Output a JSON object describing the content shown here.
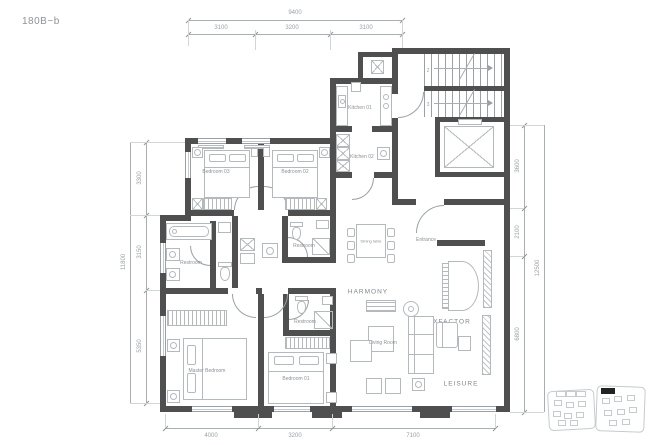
{
  "title": "180B~b",
  "rooms": {
    "bedroom03": "Bedroom 03",
    "bedroom02": "Bedroom 02",
    "kitchen01": "Kitchen 01",
    "kitchen02": "Kitchen 02",
    "restroom_main": "Restroom",
    "restroom_guest": "Restroom",
    "restroom_lower": "Restroom",
    "master_bedroom": "Master Bedroom",
    "bedroom01": "Bedroom 01",
    "living_room": "Living Room",
    "dining_table": "Dining table",
    "entrance": "Entrance"
  },
  "zones": {
    "harmony": "HARMONY",
    "xfactor": "XFACTOR",
    "leisure": "LEISURE"
  },
  "stairs": {
    "mark_upper": "2",
    "mark_lower": "3"
  },
  "dimensions": {
    "top": {
      "total": "9400",
      "segments": [
        "3100",
        "3200",
        "3100"
      ]
    },
    "bottom": {
      "segments": [
        "4000",
        "3200",
        "7100"
      ]
    },
    "left": {
      "total": "11800",
      "segments": [
        "3300",
        "3150",
        "5350"
      ]
    },
    "right": {
      "total": "12500",
      "segments": [
        "3600",
        "2100",
        "6800"
      ]
    }
  },
  "colors": {
    "wall": "#4f4f4f",
    "furniture_line": "#b4b9bd",
    "label_text": "#8b9196",
    "dimension_text": "#9aa1a7",
    "site_unit_highlight": "#222222"
  }
}
